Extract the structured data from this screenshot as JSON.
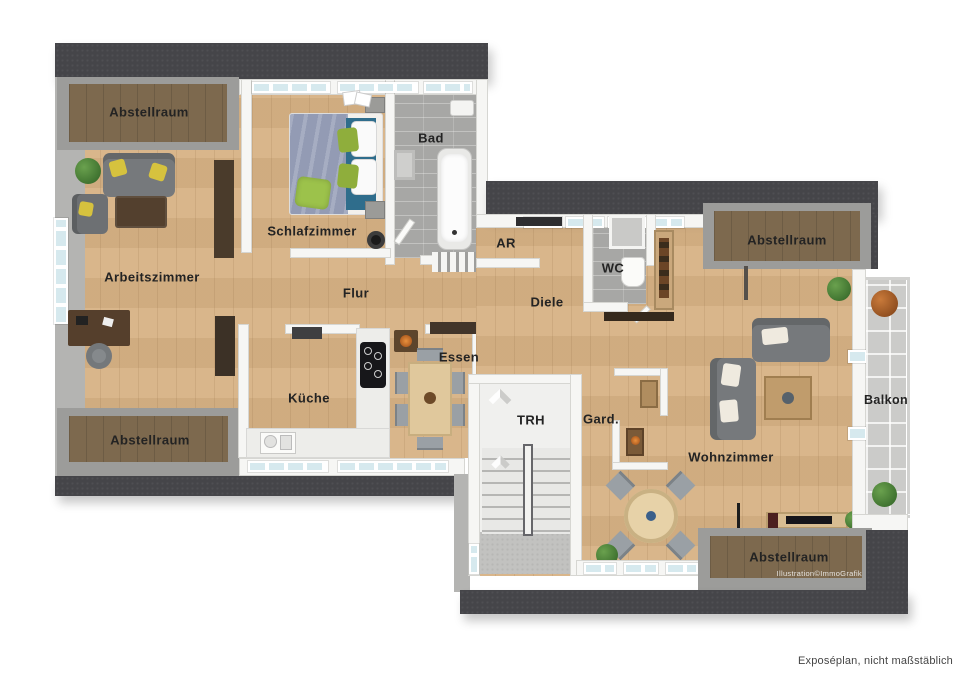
{
  "rooms": [
    {
      "id": "abstellraum-tl",
      "label": "Abstellraum"
    },
    {
      "id": "schlafzimmer",
      "label": "Schlafzimmer"
    },
    {
      "id": "bad",
      "label": "Bad"
    },
    {
      "id": "arbeitszimmer",
      "label": "Arbeitszimmer"
    },
    {
      "id": "flur",
      "label": "Flur"
    },
    {
      "id": "kueche",
      "label": "Küche"
    },
    {
      "id": "essen",
      "label": "Essen"
    },
    {
      "id": "abstellraum-bl",
      "label": "Abstellraum"
    },
    {
      "id": "ar",
      "label": "AR"
    },
    {
      "id": "wc",
      "label": "WC"
    },
    {
      "id": "diele",
      "label": "Diele"
    },
    {
      "id": "abstellraum-tr",
      "label": "Abstellraum"
    },
    {
      "id": "trh",
      "label": "TRH"
    },
    {
      "id": "gard",
      "label": "Gard."
    },
    {
      "id": "wohnzimmer",
      "label": "Wohnzimmer"
    },
    {
      "id": "balkon",
      "label": "Balkon"
    },
    {
      "id": "abstellraum-br",
      "label": "Abstellraum"
    }
  ],
  "notes": {
    "credit": "Illustration©ImmoGrafik",
    "footer": "Exposéplan, nicht maßstäblich"
  },
  "colors": {
    "wood_floor": "#d7b285",
    "dark_storage_floor": "#7d6a52",
    "roof_band": "#454549",
    "wall": "#f6f6f4",
    "gray_surround": "#9c9c9a",
    "bath_tile": "#a7a7a5",
    "balcony_tile": "#cbcbc9",
    "window_glass": "#d6e9ee",
    "sofa_gray": "#76797c",
    "pillow_yellow": "#d6c23e",
    "bed_blanket": "#939bb4",
    "bed_teal": "#2f6d8c",
    "pillow_green": "#8fae3c",
    "plant_green": "#3f7d33"
  }
}
